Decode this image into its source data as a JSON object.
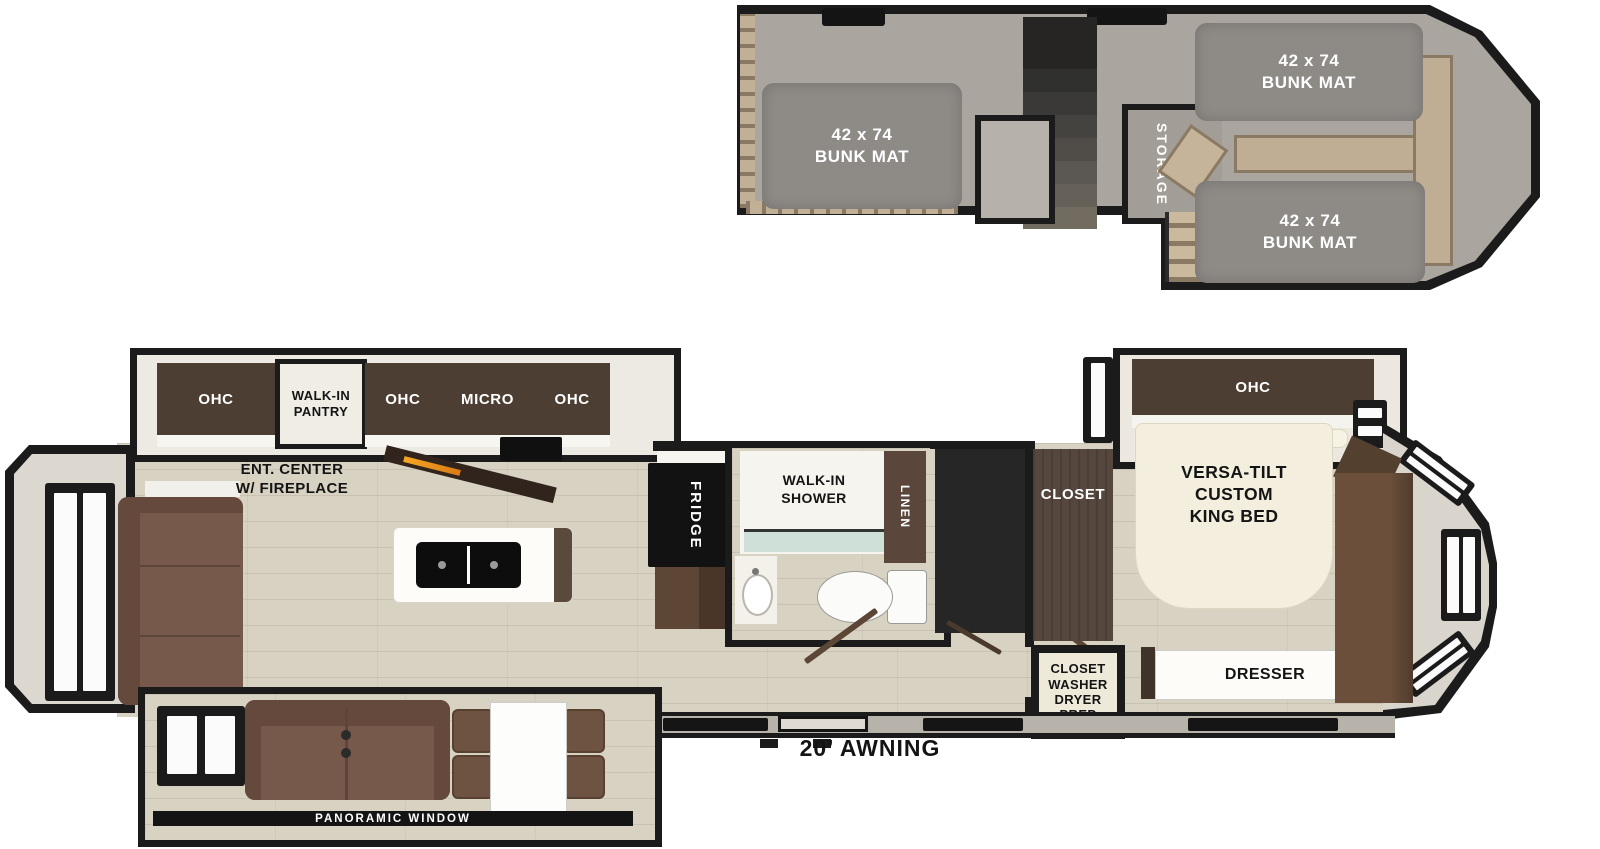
{
  "palette": {
    "wall": "#1b1b1b",
    "carpet": "#aba59f",
    "bunk_mat": "#8e8a86",
    "wood_floor": "#d8d2c3",
    "cabinet_dark_brown": "#4d3e33",
    "cabinet_wood_brown": "#5d4636",
    "sofa_brown": "#76594a",
    "ladder_tan": "#c2b096",
    "bed_cream": "#f3eedd",
    "counter_white": "#fdfcf9",
    "fireplace_orange": "#f5a623"
  },
  "loft": {
    "bunk_left": {
      "line1": "42 x 74",
      "line2": "BUNK MAT"
    },
    "bunk_front_top": {
      "line1": "42 x 74",
      "line2": "BUNK MAT"
    },
    "bunk_front_bottom": {
      "line1": "42 x 74",
      "line2": "BUNK MAT"
    },
    "storage": "STORAGE"
  },
  "main": {
    "rear_ohc": "OHC",
    "pantry": {
      "line1": "WALK-IN",
      "line2": "PANTRY"
    },
    "kitchen": {
      "ohc_left": "OHC",
      "micro": "MICRO",
      "ohc_right": "OHC"
    },
    "ent_center": {
      "line1": "ENT. CENTER",
      "line2": "W/ FIREPLACE"
    },
    "fridge": "FRIDGE",
    "bath": {
      "shower_line1": "WALK-IN",
      "shower_line2": "SHOWER",
      "linen": "LINEN"
    },
    "bedroom": {
      "closet": "CLOSET",
      "cwdp": [
        "CLOSET",
        "WASHER",
        "DRYER",
        "PREP"
      ],
      "ohc": "OHC",
      "bed": [
        "VERSA-TILT",
        "CUSTOM",
        "KING BED"
      ],
      "dresser": "DRESSER"
    },
    "awning": "20’ AWNING",
    "panoramic_window": "PANORAMIC WINDOW"
  }
}
